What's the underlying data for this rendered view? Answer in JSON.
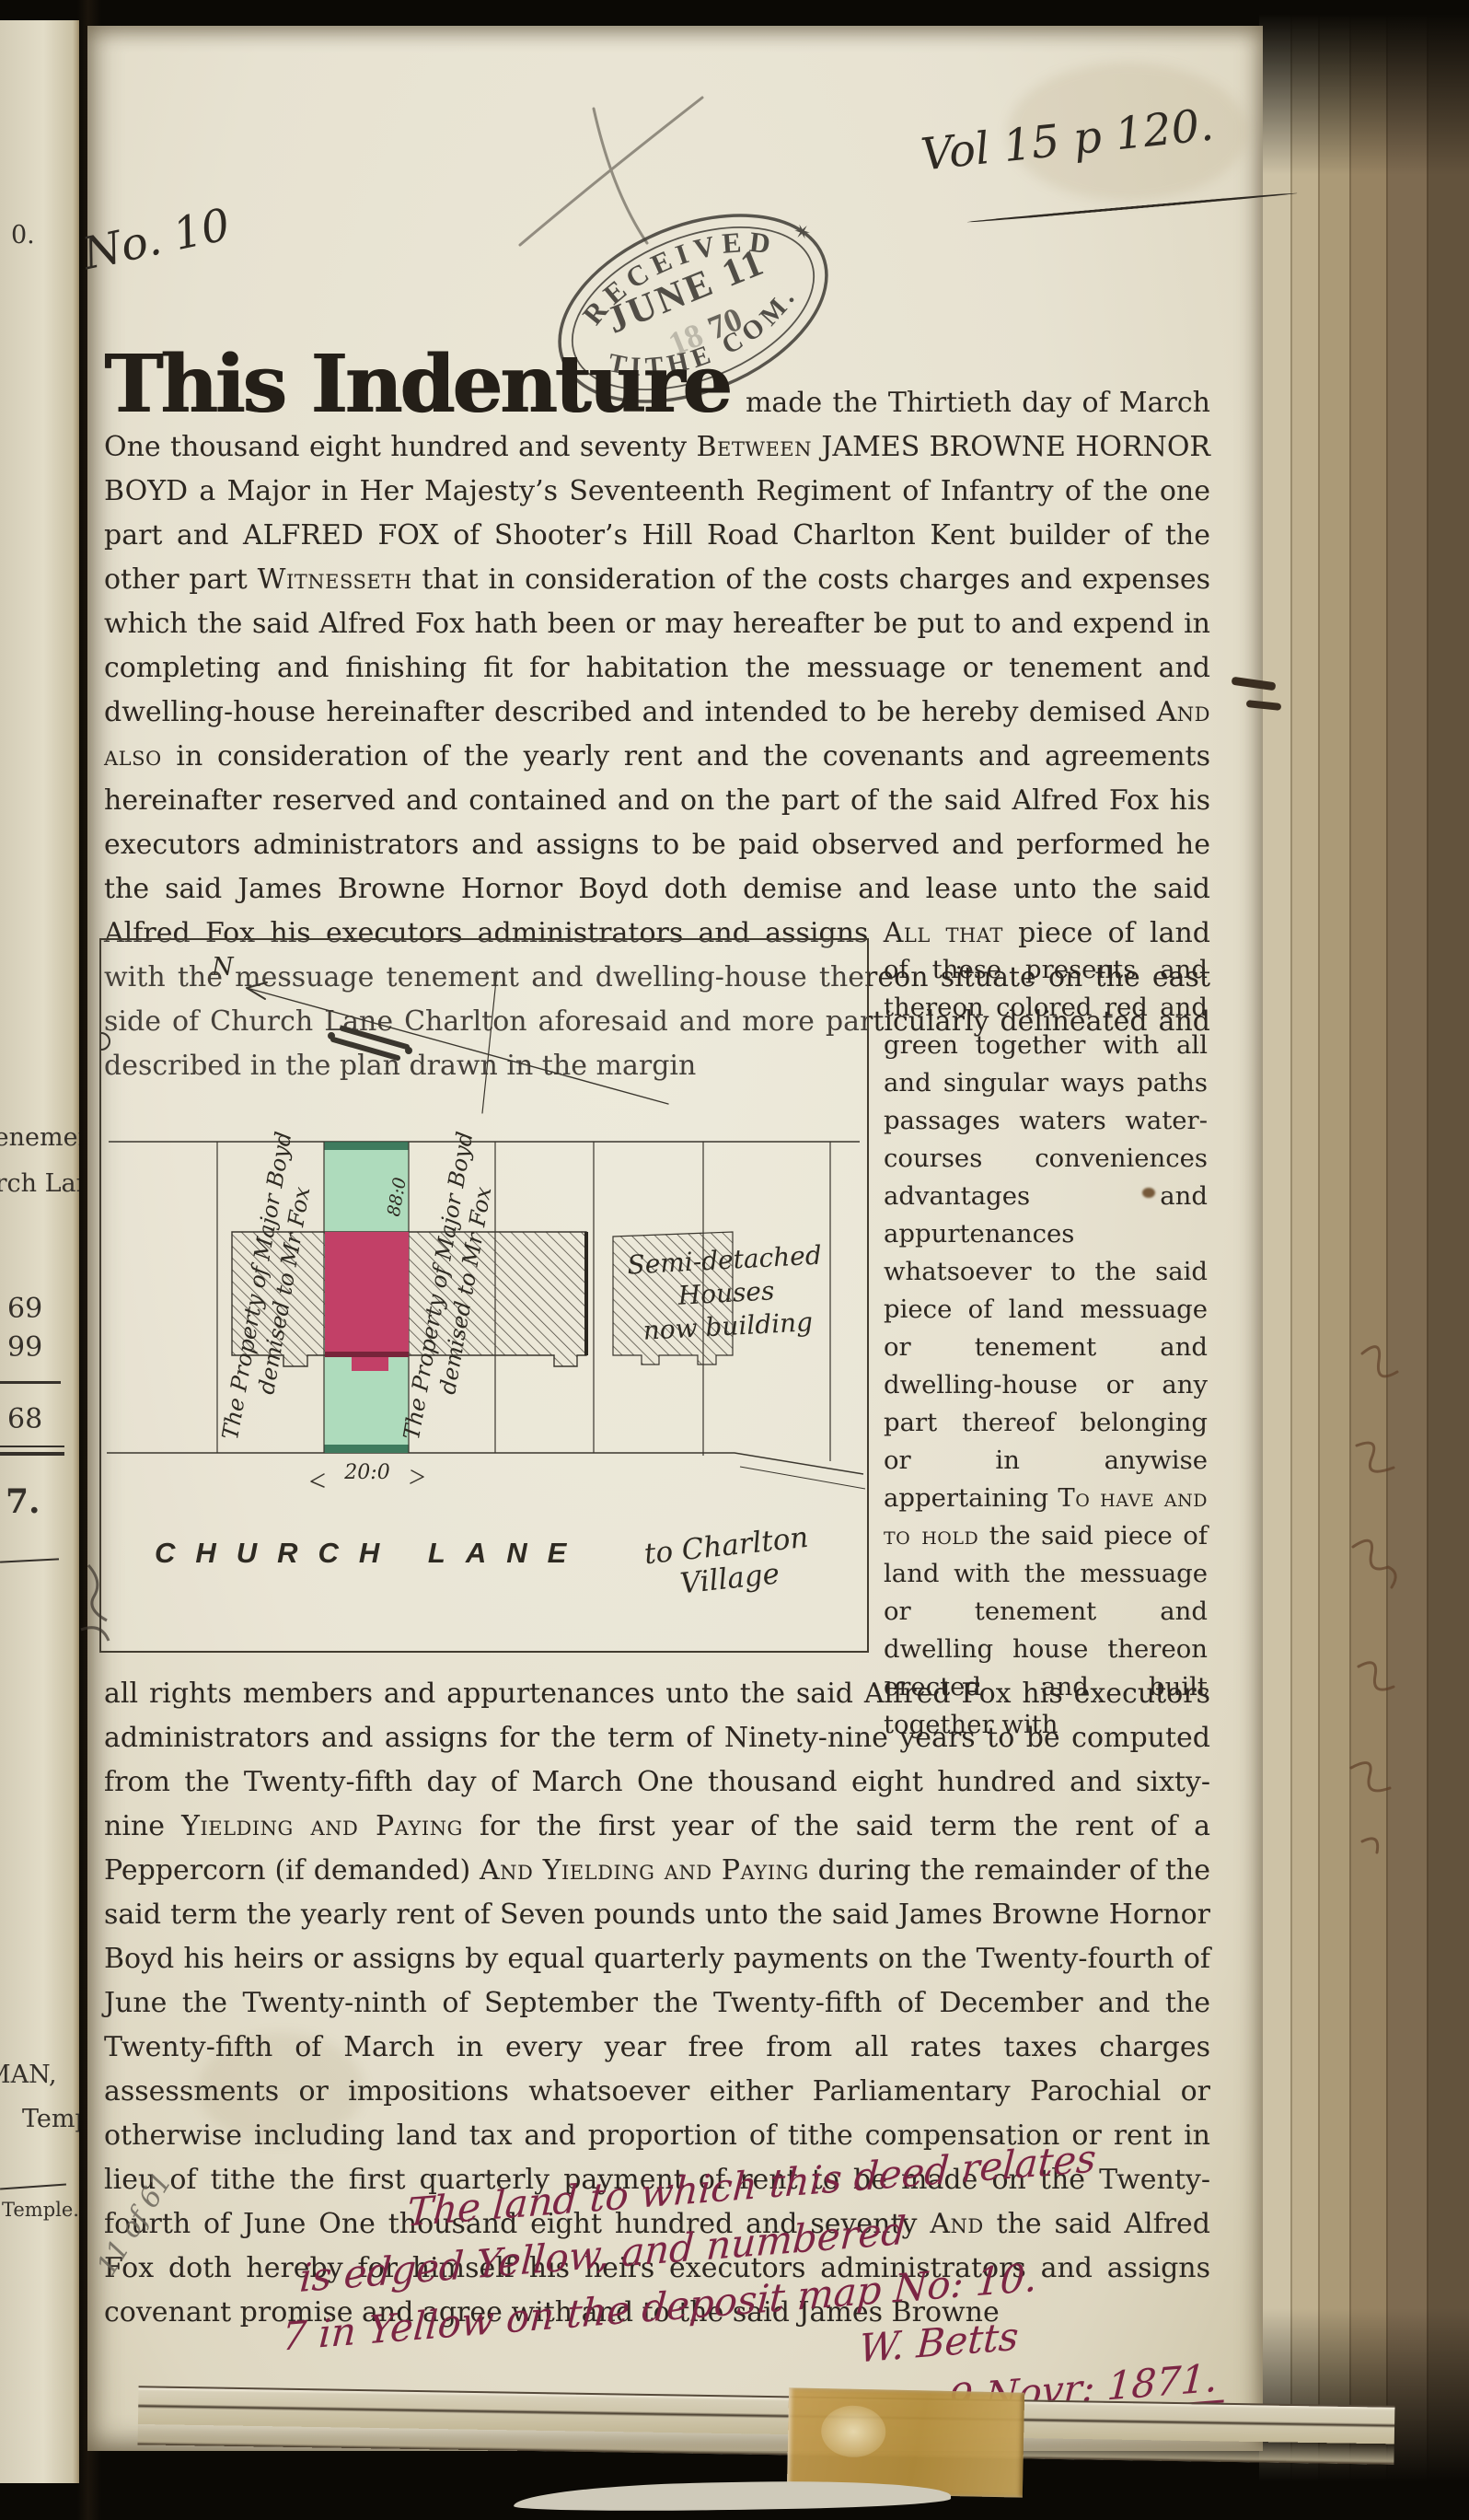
{
  "annotations": {
    "volume_ref": "Vol 15 p 120.",
    "doc_number": "No. 10",
    "pencil_note": "11 of 61"
  },
  "stamp": {
    "arc_top": "RECEIVED",
    "date_line": "JUNE 11",
    "year_faint": "18",
    "year_dark": "70",
    "arc_bottom": "TITHE COM.",
    "star": "✶"
  },
  "deed": {
    "opening": "This Indenture",
    "para1_segments": [
      {
        "t": " made the Thirtieth day of March One thousand eight hundred and seventy "
      },
      {
        "t": "Between",
        "s": "sc"
      },
      {
        "t": " JAMES BROWNE HORNOR BOYD a Major in Her Majesty’s Seventeenth Regiment of Infantry of the one part and ALFRED FOX of Shooter’s Hill Road Charlton Kent builder of the other part "
      },
      {
        "t": "Witnesseth",
        "s": "sc"
      },
      {
        "t": " that in consideration of the costs charges and expenses which the said Alfred Fox hath been or may hereafter be put to and expend in completing and finishing fit for habitation the messuage or tenement and dwelling-house hereinafter described and intended to be hereby demised "
      },
      {
        "t": "And also",
        "s": "sc"
      },
      {
        "t": " in consideration of the yearly rent and the covenants and agreements hereinafter reserved and contained and on the part of the said Alfred Fox his executors administrators and assigns to be paid observed and performed he the said James Browne Hornor Boyd doth demise and lease unto the said Alfred Fox his executors administrators and assigns "
      },
      {
        "t": "All that",
        "s": "sc"
      },
      {
        "t": " piece of land with the messuage tenement and dwelling-house thereon situate on the east side of Church Lane Charlton aforesaid and more particularly delineated and described in the plan drawn in the margin"
      }
    ],
    "side_col_segments": [
      {
        "t": "of these presents and thereon colored red and green together with all and singular ways paths passages waters water-courses conveniences advantages and appurtenances whatsoever to the said piece of land messuage or tenement and dwelling-house or any part thereof belonging or in anywise appertaining "
      },
      {
        "t": "To have and to hold",
        "s": "sc"
      },
      {
        "t": " the said piece of land with the messuage or tenement and dwelling house thereon erected and built together with"
      }
    ],
    "para2_segments": [
      {
        "t": "all rights members and appurtenances unto the said Alfred Fox his executors administrators and assigns for the term of Ninety-nine years to be computed from the Twenty-fifth day of March One thousand eight hundred and sixty-nine "
      },
      {
        "t": "Yielding and Paying",
        "s": "sc"
      },
      {
        "t": " for the first year of the said term the rent of a Peppercorn (if demanded) "
      },
      {
        "t": "And Yielding and Paying",
        "s": "sc"
      },
      {
        "t": " during the remainder of the said term the yearly rent of Seven pounds unto the said James Browne Hornor Boyd his heirs or assigns by equal quarterly payments on the Twenty-fourth of June the Twenty-ninth of September the Twenty-fifth of December and the Twenty-fifth of March in every year free from all rates taxes charges assessments or impositions whatsoever either Parliamentary Parochial or otherwise including land tax and proportion of tithe compensation or rent in lieu of tithe the first quarterly payment of rent to be made on the Twenty-fourth of June One thousand eight hundred and seventy "
      },
      {
        "t": "And",
        "s": "sc"
      },
      {
        "t": " the said Alfred Fox doth hereby for himself his heirs executors administrators and assigns covenant promise and agree with and to the said James Browne"
      }
    ]
  },
  "plan": {
    "north_label": "N",
    "strip_label_line1": "The Property of Major Boyd",
    "strip_label_line2": "demised to Mr Fox",
    "depth_measure": "88:0",
    "width_measure": "20:0",
    "houses_note_line1": "Semi-detached",
    "houses_note_line2": "Houses",
    "houses_note_line3": "now building",
    "road_name": "CHURCH LANE",
    "direction_line1": "to Charlton",
    "direction_line2": "Village",
    "colors": {
      "plot_green": "#aedbbc",
      "house_red": "#c24067"
    }
  },
  "margin_note": {
    "line1": "The land to which this deed relates",
    "line2": "is edged Yellow, and numbered",
    "line3": "7 in Yellow on the deposit map No: 10.",
    "signature": "W. Betts",
    "date": "9 Novr: 1871."
  },
  "prev_page": {
    "fragments": [
      "0.",
      "Tenemen",
      "urch Lan",
      "69",
      "99",
      "68",
      "7.",
      "MAN,",
      "Temple",
      "Temple."
    ]
  }
}
